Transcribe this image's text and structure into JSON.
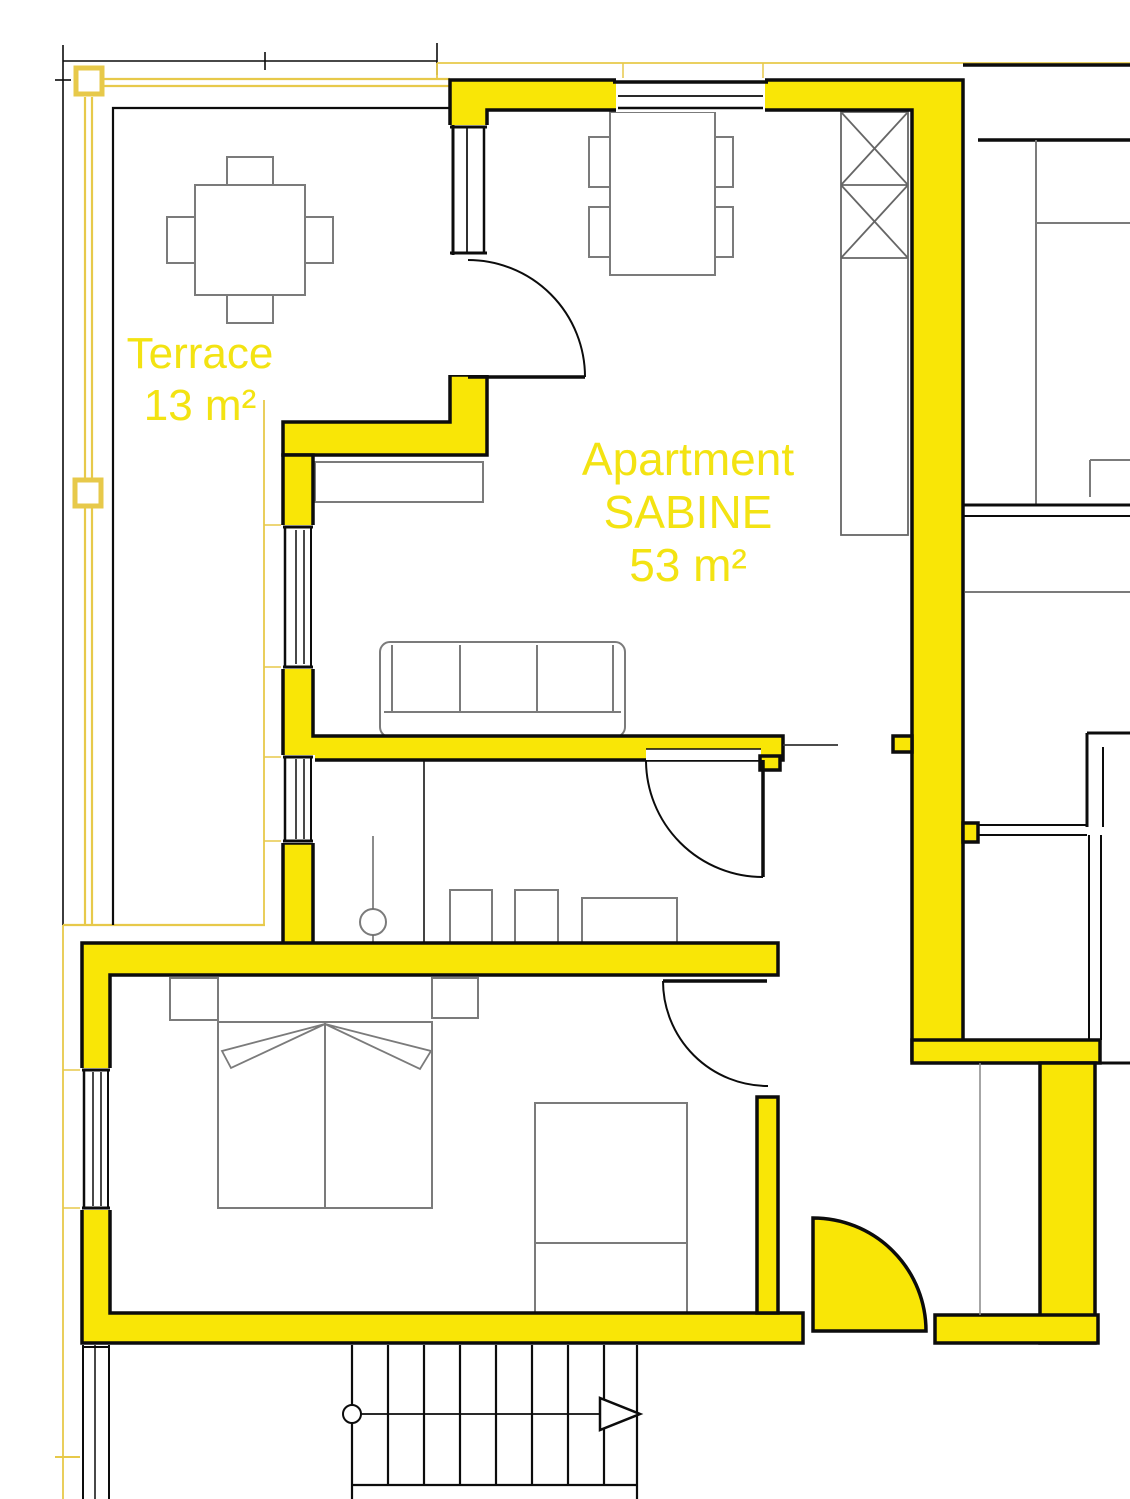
{
  "document": {
    "type": "architectural-floor-plan",
    "view": "top-down"
  },
  "labels": {
    "terrace_name": "Terrace",
    "terrace_area": "13 m²",
    "apartment_line1": "Apartment",
    "apartment_line2": "SABINE",
    "apartment_area": "53 m²"
  },
  "colors": {
    "wall": "#f9e606",
    "text": "#f3e312",
    "railing": "#e7c94a",
    "line": "#0c0c0c",
    "furn": "#7b7b7b",
    "bg": "#ffffff"
  },
  "rooms": [
    {
      "name": "terrace",
      "area_label": "13 m²"
    },
    {
      "name": "living-dining-room",
      "area_label": null
    },
    {
      "name": "bathroom",
      "area_label": null
    },
    {
      "name": "bedroom",
      "area_label": null
    },
    {
      "name": "entrance-hall",
      "area_label": null
    }
  ],
  "symbols": [
    "terrace-table-with-4-chairs",
    "dining-table-with-4-chairs",
    "tall-cabinet-with-x-boxes",
    "sideboard",
    "three-seat-sofa",
    "double-bed-with-nightstands",
    "wardrobe",
    "bathroom-fixtures",
    "swing-door",
    "entrance-door-filled",
    "staircase-with-direction-arrow"
  ]
}
